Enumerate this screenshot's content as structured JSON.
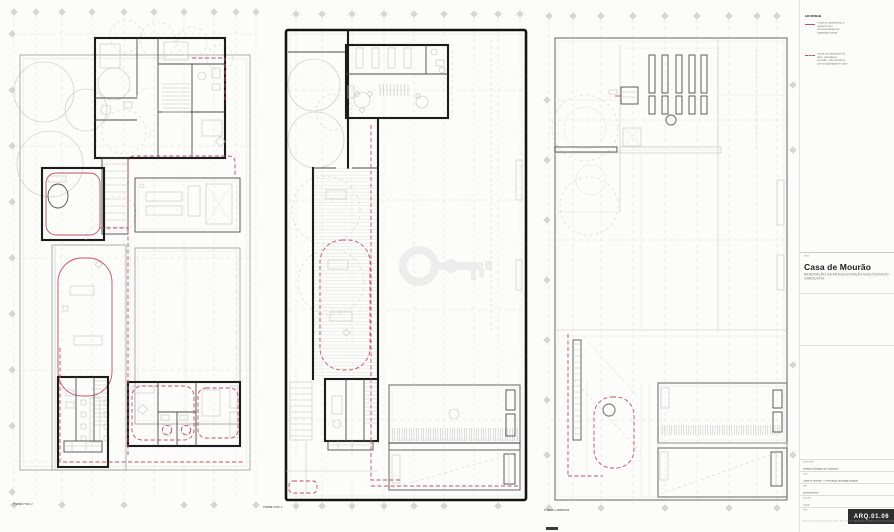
{
  "sheet": {
    "width": 894,
    "height": 532
  },
  "colors": {
    "red": "#c35061",
    "wall": "#1c1c1c",
    "grid": "#e4e0d8",
    "paper": "#fcfcfb"
  },
  "plans": [
    {
      "id": "piso-0",
      "label": "Planta Piso 0"
    },
    {
      "id": "piso-1",
      "label": "Planta Piso 1"
    },
    {
      "id": "cobertura",
      "label": "Planta Cobertura"
    }
  ],
  "legend": {
    "title": "LEGENDA",
    "items": [
      {
        "swatch": "red-solid",
        "text": "Peças de acabamento a existente sem correspondência na legalização antiga"
      },
      {
        "swatch": "red-dashed",
        "text": "Peças com alterações de vãos, marcadas a vermelho, não conformes com a legalização em vigor"
      }
    ]
  },
  "watermark": {
    "icon": "key"
  },
  "titleblock": {
    "project_label": "obra",
    "project_title": "Casa de Mourão",
    "project_subtitle": "Renovação da antiga Estação Biológica do Garducho",
    "rows": [
      {
        "label": "requerente",
        "value": "Estação Biológica do Garducho"
      },
      {
        "label": "obra",
        "value": "Casa de Mourão — renovação da antiga estação"
      },
      {
        "label": "fase",
        "value": "licenciamento"
      },
      {
        "label": "escalas",
        "value": "1:100"
      },
      {
        "label": "data",
        "value": "desenho nº"
      }
    ],
    "sheet_code": "ARQ.01.06",
    "fine_print": "este desenho é propriedade do autor e não pode ser reproduzido no todo ou em parte sem autorização escrita"
  }
}
